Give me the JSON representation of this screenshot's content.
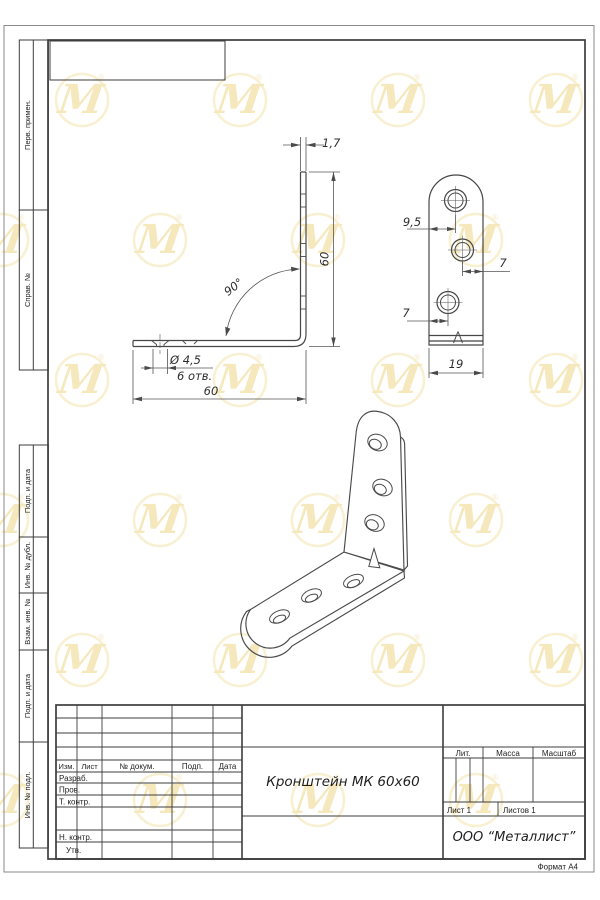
{
  "sheet": {
    "title": "Кронштейн МК 60х60",
    "company": "ООО “Металлист”",
    "format_label": "Формат А4"
  },
  "margin_labels": [
    "Перв. примен.",
    "Справ. №",
    "Подп. и дата",
    "Инв. № дубл.",
    "Взам. инв. №",
    "Подп. и дата",
    "Инв. № подл."
  ],
  "title_block": {
    "col_izm": "Изм.",
    "col_list": "Лист",
    "col_dokum": "№ докум.",
    "col_podp": "Подп.",
    "col_data": "Дата",
    "row_razrab": "Разраб.",
    "row_prov": "Пров.",
    "row_tkontr": "Т. контр.",
    "row_nkontr": "Н. контр.",
    "row_utv": "Утв.",
    "lit_label": "Лит.",
    "mass_label": "Масса",
    "scale_label": "Масштаб",
    "sheet_no": "Лист 1",
    "sheets_total": "Листов 1"
  },
  "dimensions": {
    "front": {
      "thickness": "1,7",
      "height": "60",
      "angle": "90°",
      "hole_dia": "Ø 4,5",
      "hole_count": "6 отв.",
      "width": "60"
    },
    "side": {
      "edge_to_hole": "9,5",
      "hole_offset_right": "7",
      "hole_offset_left": "7",
      "width": "19"
    }
  },
  "brand": {
    "watermark_letter": "M",
    "registered_mark": "®",
    "watermark_ring_color": "#f2e3ab",
    "watermark_letter_color": "#efd688"
  },
  "line_colors": {
    "frame": "#3d3d3d",
    "drawing": "#464646",
    "dimension": "#555555"
  }
}
